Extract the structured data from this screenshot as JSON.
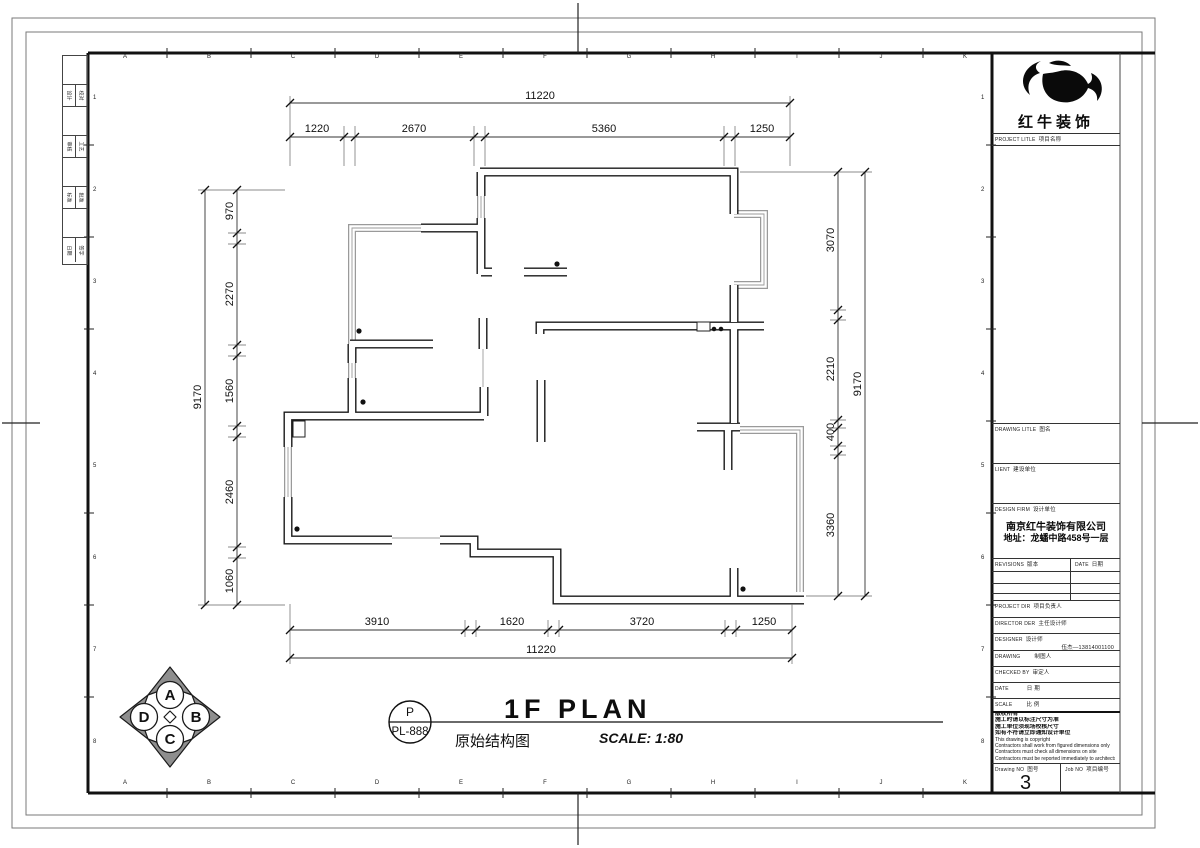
{
  "sheet": {
    "grid_letters": [
      "A",
      "B",
      "C",
      "D",
      "E",
      "F",
      "G",
      "H",
      "I",
      "J",
      "K"
    ],
    "grid_numbers": [
      "1",
      "2",
      "3",
      "4",
      "5",
      "6",
      "7",
      "8"
    ],
    "signoff_rows": [
      [
        "设计",
        "校对"
      ],
      [
        "审核",
        "工艺"
      ],
      [
        "标准",
        "批准"
      ],
      [
        "日期",
        "签字"
      ]
    ]
  },
  "plan": {
    "dims_top": {
      "overall": "11220",
      "seg1": "1220",
      "seg2": "2670",
      "seg3": "5360",
      "seg4": "1250"
    },
    "dims_bottom": {
      "overall": "11220",
      "seg1": "3910",
      "seg2": "1620",
      "seg3": "3720",
      "seg4": "1250"
    },
    "dims_left": {
      "overall": "9170",
      "seg1": "970",
      "seg2": "2270",
      "seg3": "1560",
      "seg4": "2460",
      "seg5": "1060"
    },
    "dims_right": {
      "overall": "9170",
      "seg1": "3070",
      "seg2": "2210",
      "seg3": "400",
      "seg4": "3360"
    }
  },
  "footer": {
    "compass_top": "A",
    "compass_left": "D",
    "compass_right": "B",
    "compass_bottom": "C",
    "bubble_top": "P",
    "bubble_bottom": "PL-888",
    "title_en": "1F PLAN",
    "title_zh": "原始结构图",
    "scale": "SCALE: 1:80"
  },
  "title_block": {
    "brand": "红牛装饰",
    "project_title_en": "PROJECT LITLE",
    "project_title_zh": "项目名称",
    "drawing_title_en": "DRAWING LITLE",
    "drawing_title_zh": "图名",
    "client_en": "LIENT",
    "client_zh": "建设单位",
    "design_firm_en": "DESIGN FIRM",
    "design_firm_zh": "设计单位",
    "firm_name": "南京红牛装饰有限公司",
    "firm_address": "地址：龙蟠中路458号一层",
    "revisions_en": "REVISIONS",
    "revisions_zh": "版本",
    "rev_date_en": "DATE",
    "rev_date_zh": "日期",
    "project_dir_en": "PROJECT DIR",
    "project_dir_zh": "项目负责人",
    "director_en": "DIRECTOR DER",
    "director_zh": "主任设计师",
    "designer_en": "DESIGNER",
    "designer_zh": "设计师",
    "designer_value": "伍杰—13814001100",
    "drawing_by_en": "DRAWING",
    "drawing_by_zh": "制图人",
    "checked_by_en": "CHECKED BY",
    "checked_by_zh": "审定人",
    "date_row_en": "DATE",
    "date_row_zh": "日 期",
    "scale_row_en": "SCALE",
    "scale_row_zh": "比 例",
    "notes": [
      "版权所有",
      "施工时请以标注尺寸为准",
      "施工单位须现场校核尺寸",
      "如有不符请立即通知设计单位",
      "This drawing is copyright",
      "Contractors shall work from figured dimensions only",
      "Contractors must check all dimensions on site",
      "Contractors must be reported immediately to architects"
    ],
    "drawing_no_en": "Drawing NO",
    "drawing_no_zh": "图号",
    "drawing_no_value": "3",
    "job_no_en": "Job NO",
    "job_no_zh": "项目编号"
  }
}
